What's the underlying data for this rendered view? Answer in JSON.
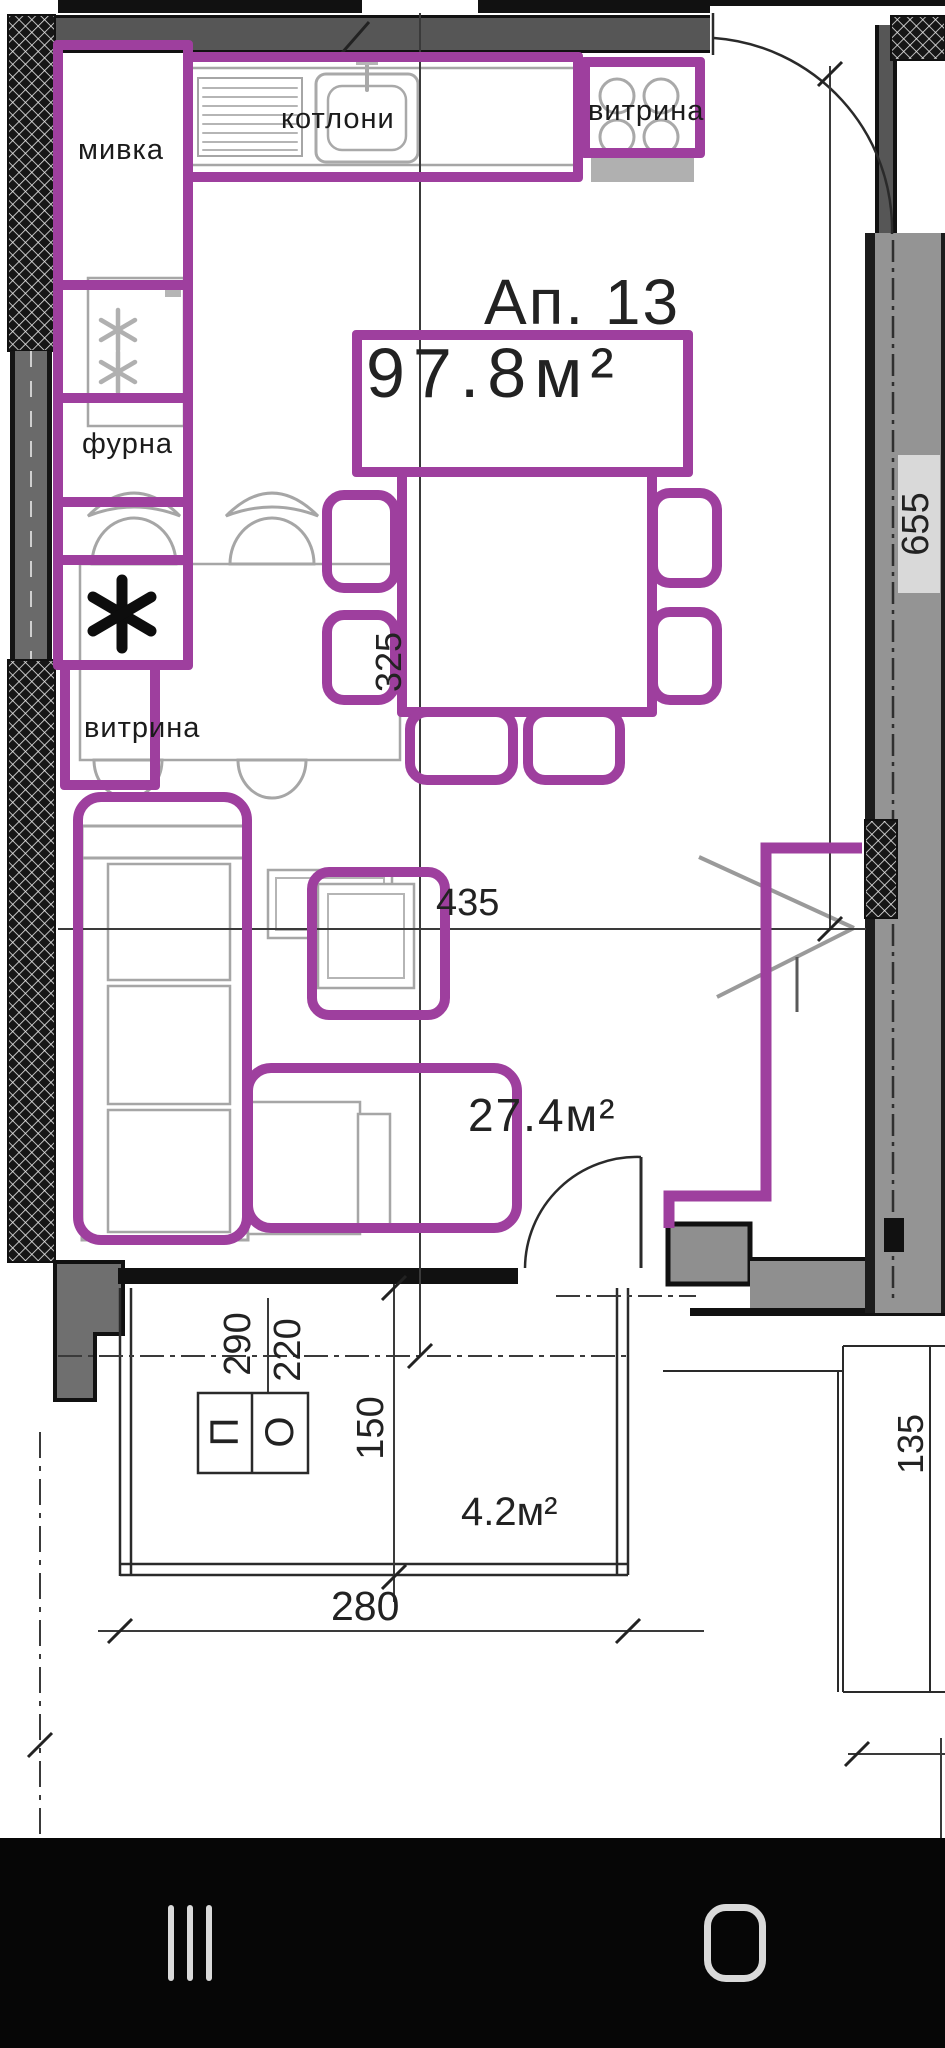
{
  "colors": {
    "annotation_purple": "#9e3f9e",
    "wall_gray": "#565656"
  },
  "plan": {
    "unit_label": "Ап. 13",
    "unit_area": "97.8м²",
    "living_area": "27.4м²",
    "balcony_area": "4.2м²",
    "label_sink": "мивка",
    "label_hob": "котлони",
    "label_vitrine_top": "витрина",
    "label_oven": "фурна",
    "label_vitrine_left": "витрина",
    "dim_325": "325",
    "dim_655": "655",
    "dim_435": "435",
    "dim_290": "290",
    "dim_220": "220",
    "dim_150": "150",
    "dim_280": "280",
    "dim_135": "135",
    "mark_p": "П",
    "mark_o": "О"
  }
}
